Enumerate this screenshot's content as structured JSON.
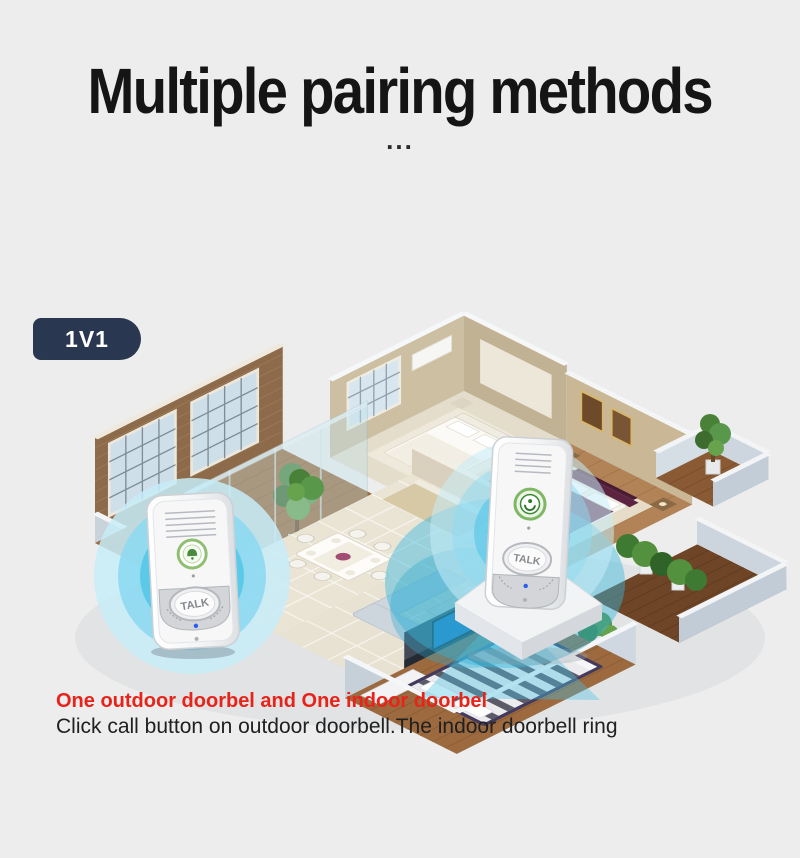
{
  "background": "#ededed",
  "title": {
    "text": "Multiple pairing methods",
    "color": "#151515"
  },
  "ellipsis": "...",
  "badge": {
    "label": "1V1",
    "bg": "#2a3750",
    "color": "#ffffff"
  },
  "floorplan": {
    "description": "isometric 3D apartment floor plan with one outdoor doorbell and one indoor doorbell connected by wireless signal ripples",
    "outdoor_doorbell": {
      "talk_label": "TALK"
    },
    "indoor_doorbell": {
      "talk_label": "TALK"
    },
    "ripple_color": "#45c0e6"
  },
  "caption": {
    "headline": {
      "text": "One outdoor doorbel and One indoor doorbel",
      "color": "#e8231a"
    },
    "body": {
      "text": "Click call button on outdoor doorbell.The indoor doorbell ring",
      "color": "#202020"
    }
  }
}
